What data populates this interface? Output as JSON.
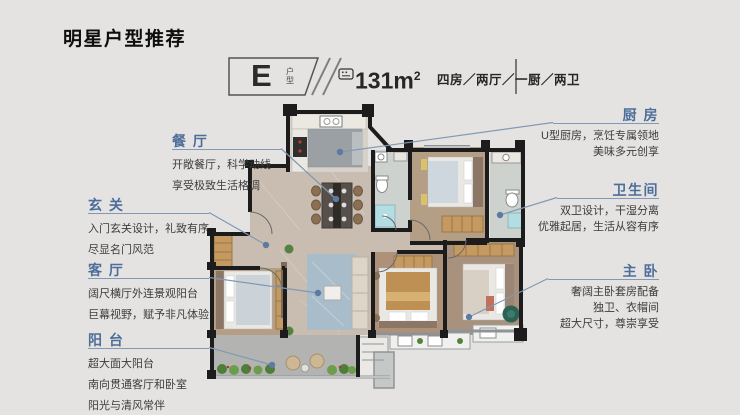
{
  "page": {
    "title": "明星户型推荐"
  },
  "theme": {
    "background": "#e4e3e1",
    "accent_blue": "#4d6e9a",
    "leader_line": "#8199b4",
    "body_text": "#3c3c3c",
    "wall_black": "#1c1c1c"
  },
  "unit_badge": {
    "letter": "E",
    "suffix": "户型",
    "divider_icon": "double-slash-divider"
  },
  "area": {
    "icon": "floor-area-icon",
    "value": "131m",
    "sup": "2",
    "layout": "四房／两厅／一厨／两卫"
  },
  "annotations_left": [
    {
      "title": "餐 厅",
      "lines": [
        "开敞餐厅，科学动线",
        "享受极致生活格调"
      ]
    },
    {
      "title": "玄 关",
      "lines": [
        "入门玄关设计，礼致有序",
        "尽显名门风范"
      ]
    },
    {
      "title": "客 厅",
      "lines": [
        "阔尺横厅外连景观阳台",
        "巨幕视野，赋予非凡体验"
      ]
    },
    {
      "title": "阳 台",
      "lines": [
        "超大面大阳台",
        "南向贯通客厅和卧室",
        "阳光与清风常伴"
      ]
    }
  ],
  "annotations_right": [
    {
      "title": "厨 房",
      "lines": [
        "U型厨房，烹饪专属领地",
        "美味多元创享"
      ]
    },
    {
      "title": "卫生间",
      "lines": [
        "双卫设计，干湿分离",
        "优雅起居，生活从容有序"
      ]
    },
    {
      "title": "主 卧",
      "lines": [
        "奢阔主卧套房配备",
        "独卫、衣帽间",
        "超大尺寸，尊崇享受"
      ]
    }
  ]
}
